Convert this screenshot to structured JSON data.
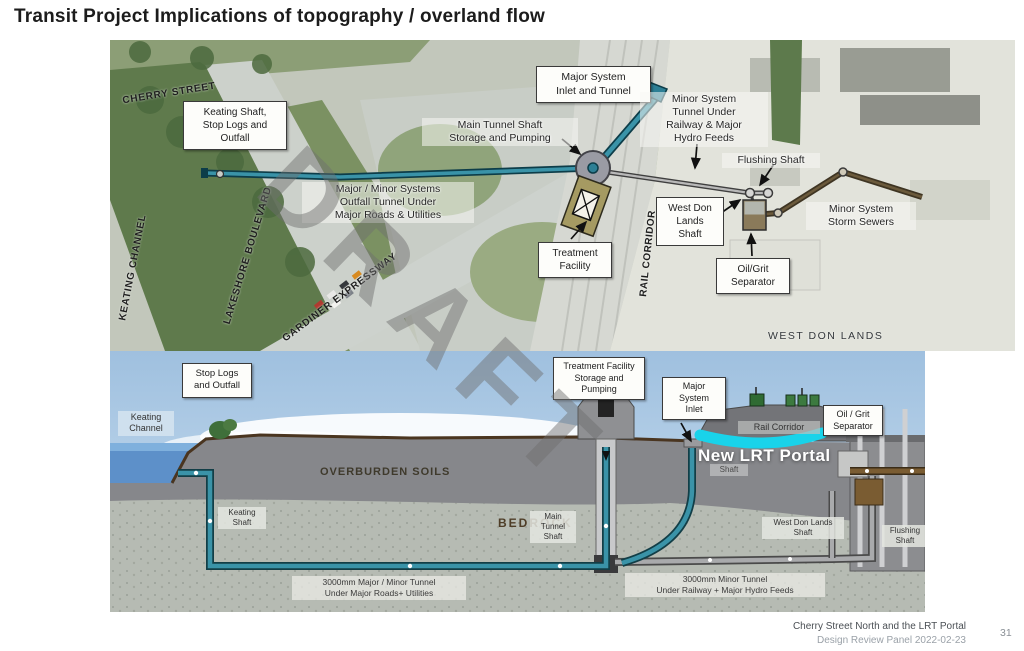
{
  "title": "Transit Project Implications of topography / overland flow",
  "watermark": "DRAFT",
  "map": {
    "labels": {
      "cherry_street": "CHERRY STREET",
      "keating_channel": "KEATING CHANNEL",
      "lakeshore": "LAKESHORE BOULEVARD",
      "gardiner": "GARDINER EXPRESSWAY",
      "rail_corridor": "RAIL CORRIDOR",
      "west_don_lands": "WEST DON LANDS",
      "keating_shaft_box": "Keating Shaft,\nStop Logs and\nOutfall",
      "major_system_box": "Major System\nInlet and Tunnel",
      "main_tunnel_note": "Main Tunnel Shaft\nStorage and Pumping",
      "minor_system_note": "Minor System\nTunnel Under\nRailway & Major\nHydro Feeds",
      "outfall_note": "Major / Minor Systems\nOutfall Tunnel Under\nMajor Roads & Utilities",
      "treatment_box": "Treatment\nFacility",
      "west_don_shaft_box": "West Don\nLands\nShaft",
      "flushing_note": "Flushing Shaft",
      "storm_note": "Minor System\nStorm Sewers",
      "oilgrit_box": "Oil/Grit\nSeparator"
    }
  },
  "section": {
    "labels": {
      "stop_logs_box": "Stop Logs\nand Outfall",
      "keating_channel": "Keating\nChannel",
      "treatment_box": "Treatment Facility\nStorage and\nPumping",
      "major_inlet_box": "Major\nSystem\nInlet",
      "oilgrit_box": "Oil / Grit\nSeparator",
      "rail_corridor": "Rail Corridor",
      "new_lrt_portal": "New LRT Portal",
      "shaft_small": "Shaft",
      "overburden": "OVERBURDEN SOILS",
      "bedrock": "BEDROCK",
      "keating_shaft": "Keating\nShaft",
      "main_tunnel_shaft": "Main\nTunnel\nShaft",
      "west_don_shaft": "West Don Lands\nShaft",
      "flushing_shaft": "Flushing\nShaft",
      "tunnel_major_note": "3000mm Major / Minor Tunnel\nUnder Major Roads+ Utilities",
      "tunnel_minor_note": "3000mm Minor Tunnel\nUnder Railway + Major Hydro Feeds"
    }
  },
  "footer": {
    "line1": "Cherry Street North and the LRT Portal",
    "line2": "Design Review Panel 2022-02-23",
    "page": "31"
  },
  "colors": {
    "major_tunnel_teal": "#2e7f95",
    "minor_tunnel_gray": "#9a9a9c",
    "storm_sewer_brown": "#5a4428",
    "lrt_portal_cyan": "#19d3ea",
    "sky": "#a9c7e2",
    "water": "#5d90c9",
    "overburden_gray": "#86878b",
    "bedrock_gray": "#b6bbb3",
    "watermark_gray": "#6e6e6e"
  }
}
